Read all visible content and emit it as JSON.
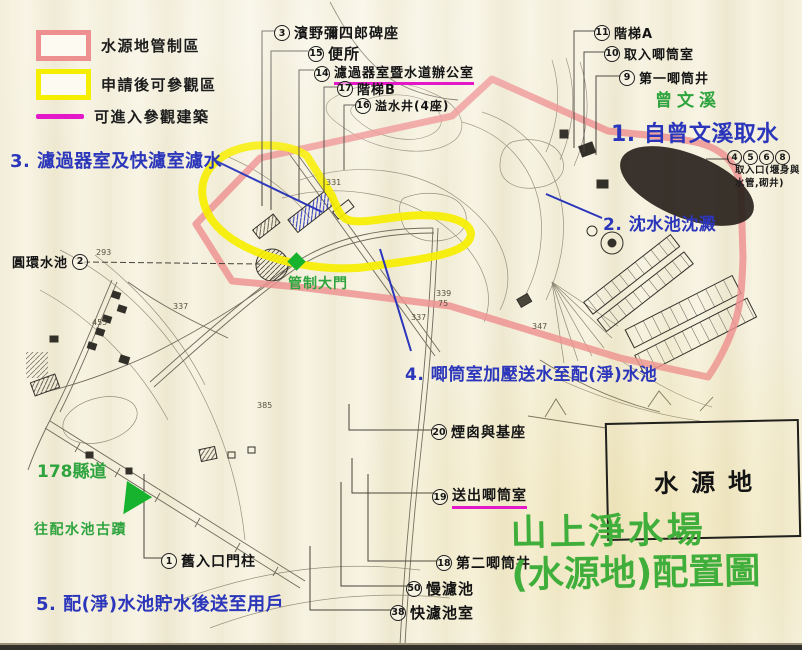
{
  "colors": {
    "pink": "#ee9090",
    "yellow": "#f6ee00",
    "magenta": "#e318c8",
    "blue": "#2b36bb",
    "green": "#2ea43e",
    "titlegreen": "#3fae3a",
    "brightgreen": "#17b32e",
    "ink": "#45423a"
  },
  "legend": {
    "items": [
      {
        "label": "水源地管制區",
        "type": "pink-box"
      },
      {
        "label": "申請後可參觀區",
        "type": "yellow-box"
      },
      {
        "label": "可進入參觀建築",
        "type": "magenta-line"
      }
    ]
  },
  "steps": [
    {
      "text": "1. 自曾文溪取水",
      "x": 611,
      "y": 116,
      "size": 22
    },
    {
      "text": "2. 沈水池沈澱",
      "x": 603,
      "y": 210,
      "size": 17
    },
    {
      "text": "3. 濾過器室及快濾室濾水",
      "x": 10,
      "y": 147,
      "size": 18
    },
    {
      "text": "4. 唧筒室加壓送水至配(淨)水池",
      "x": 405,
      "y": 360,
      "size": 17
    },
    {
      "text": "5. 配(淨)水池貯水後送至用戶",
      "x": 36,
      "y": 590,
      "size": 18
    }
  ],
  "green_labels": [
    {
      "text": "曾文溪",
      "x": 655,
      "y": 86,
      "size": 17,
      "spacing": 5
    },
    {
      "text": "管制大門",
      "x": 288,
      "y": 273,
      "size": 14,
      "spacing": 1
    },
    {
      "text": "178縣道",
      "x": 37,
      "y": 457,
      "size": 17,
      "spacing": 0
    },
    {
      "text": "往配水池古蹟",
      "x": 34,
      "y": 519,
      "size": 14,
      "spacing": 1.5
    }
  ],
  "title": {
    "line1": "山上淨水場",
    "line2": "(水源地)配置圖"
  },
  "area_box": {
    "label": "水源地"
  },
  "callouts": [
    {
      "num": "3",
      "label": "濱野彌四郎碑座",
      "x": 274,
      "y": 23,
      "size": 14
    },
    {
      "num": "15",
      "label": "便所",
      "x": 308,
      "y": 43,
      "size": 15
    },
    {
      "num": "14",
      "label": "濾過器室暨水道辦公室",
      "x": 314,
      "y": 62,
      "size": 13,
      "cls": "underline"
    },
    {
      "num": "17",
      "label": "階梯B",
      "x": 337,
      "y": 79,
      "size": 13
    },
    {
      "num": "16",
      "label": "溢水井(4座)",
      "x": 355,
      "y": 97,
      "size": 12
    },
    {
      "num": "11",
      "label": "階梯A",
      "x": 594,
      "y": 23,
      "size": 13
    },
    {
      "num": "10",
      "label": "取入唧筒室",
      "x": 604,
      "y": 44,
      "size": 13
    },
    {
      "num": "9",
      "label": "第一唧筒井",
      "x": 619,
      "y": 68,
      "size": 13
    },
    {
      "num": "2",
      "label": "圓環水池",
      "x": 12,
      "y": 252,
      "size": 13,
      "cls": "reverse"
    },
    {
      "num": "20",
      "label": "煙囪與基座",
      "x": 431,
      "y": 422,
      "size": 14
    },
    {
      "num": "19",
      "label": "送出唧筒室",
      "x": 432,
      "y": 485,
      "size": 14,
      "cls": "underline"
    },
    {
      "num": "18",
      "label": "第二唧筒井",
      "x": 436,
      "y": 553,
      "size": 14
    },
    {
      "num": "50",
      "label": "慢濾池",
      "x": 406,
      "y": 578,
      "size": 15
    },
    {
      "num": "38",
      "label": "快濾池室",
      "x": 390,
      "y": 602,
      "size": 15
    },
    {
      "num": "1",
      "label": "舊入口門柱",
      "x": 161,
      "y": 551,
      "size": 14
    }
  ],
  "intake": {
    "nums": [
      "4",
      "5",
      "6",
      "8"
    ],
    "note1": "取入口(堰身與",
    "note2": "水管,砌井)"
  },
  "map_numbers": [
    {
      "t": "455",
      "x": 92,
      "y": 318
    },
    {
      "t": "337",
      "x": 173,
      "y": 302
    },
    {
      "t": "337",
      "x": 411,
      "y": 313
    },
    {
      "t": "331",
      "x": 326,
      "y": 178
    },
    {
      "t": "339",
      "x": 436,
      "y": 289
    },
    {
      "t": "75",
      "x": 438,
      "y": 299
    },
    {
      "t": "347",
      "x": 532,
      "y": 322
    },
    {
      "t": "293",
      "x": 96,
      "y": 248
    },
    {
      "t": "385",
      "x": 257,
      "y": 401
    }
  ]
}
